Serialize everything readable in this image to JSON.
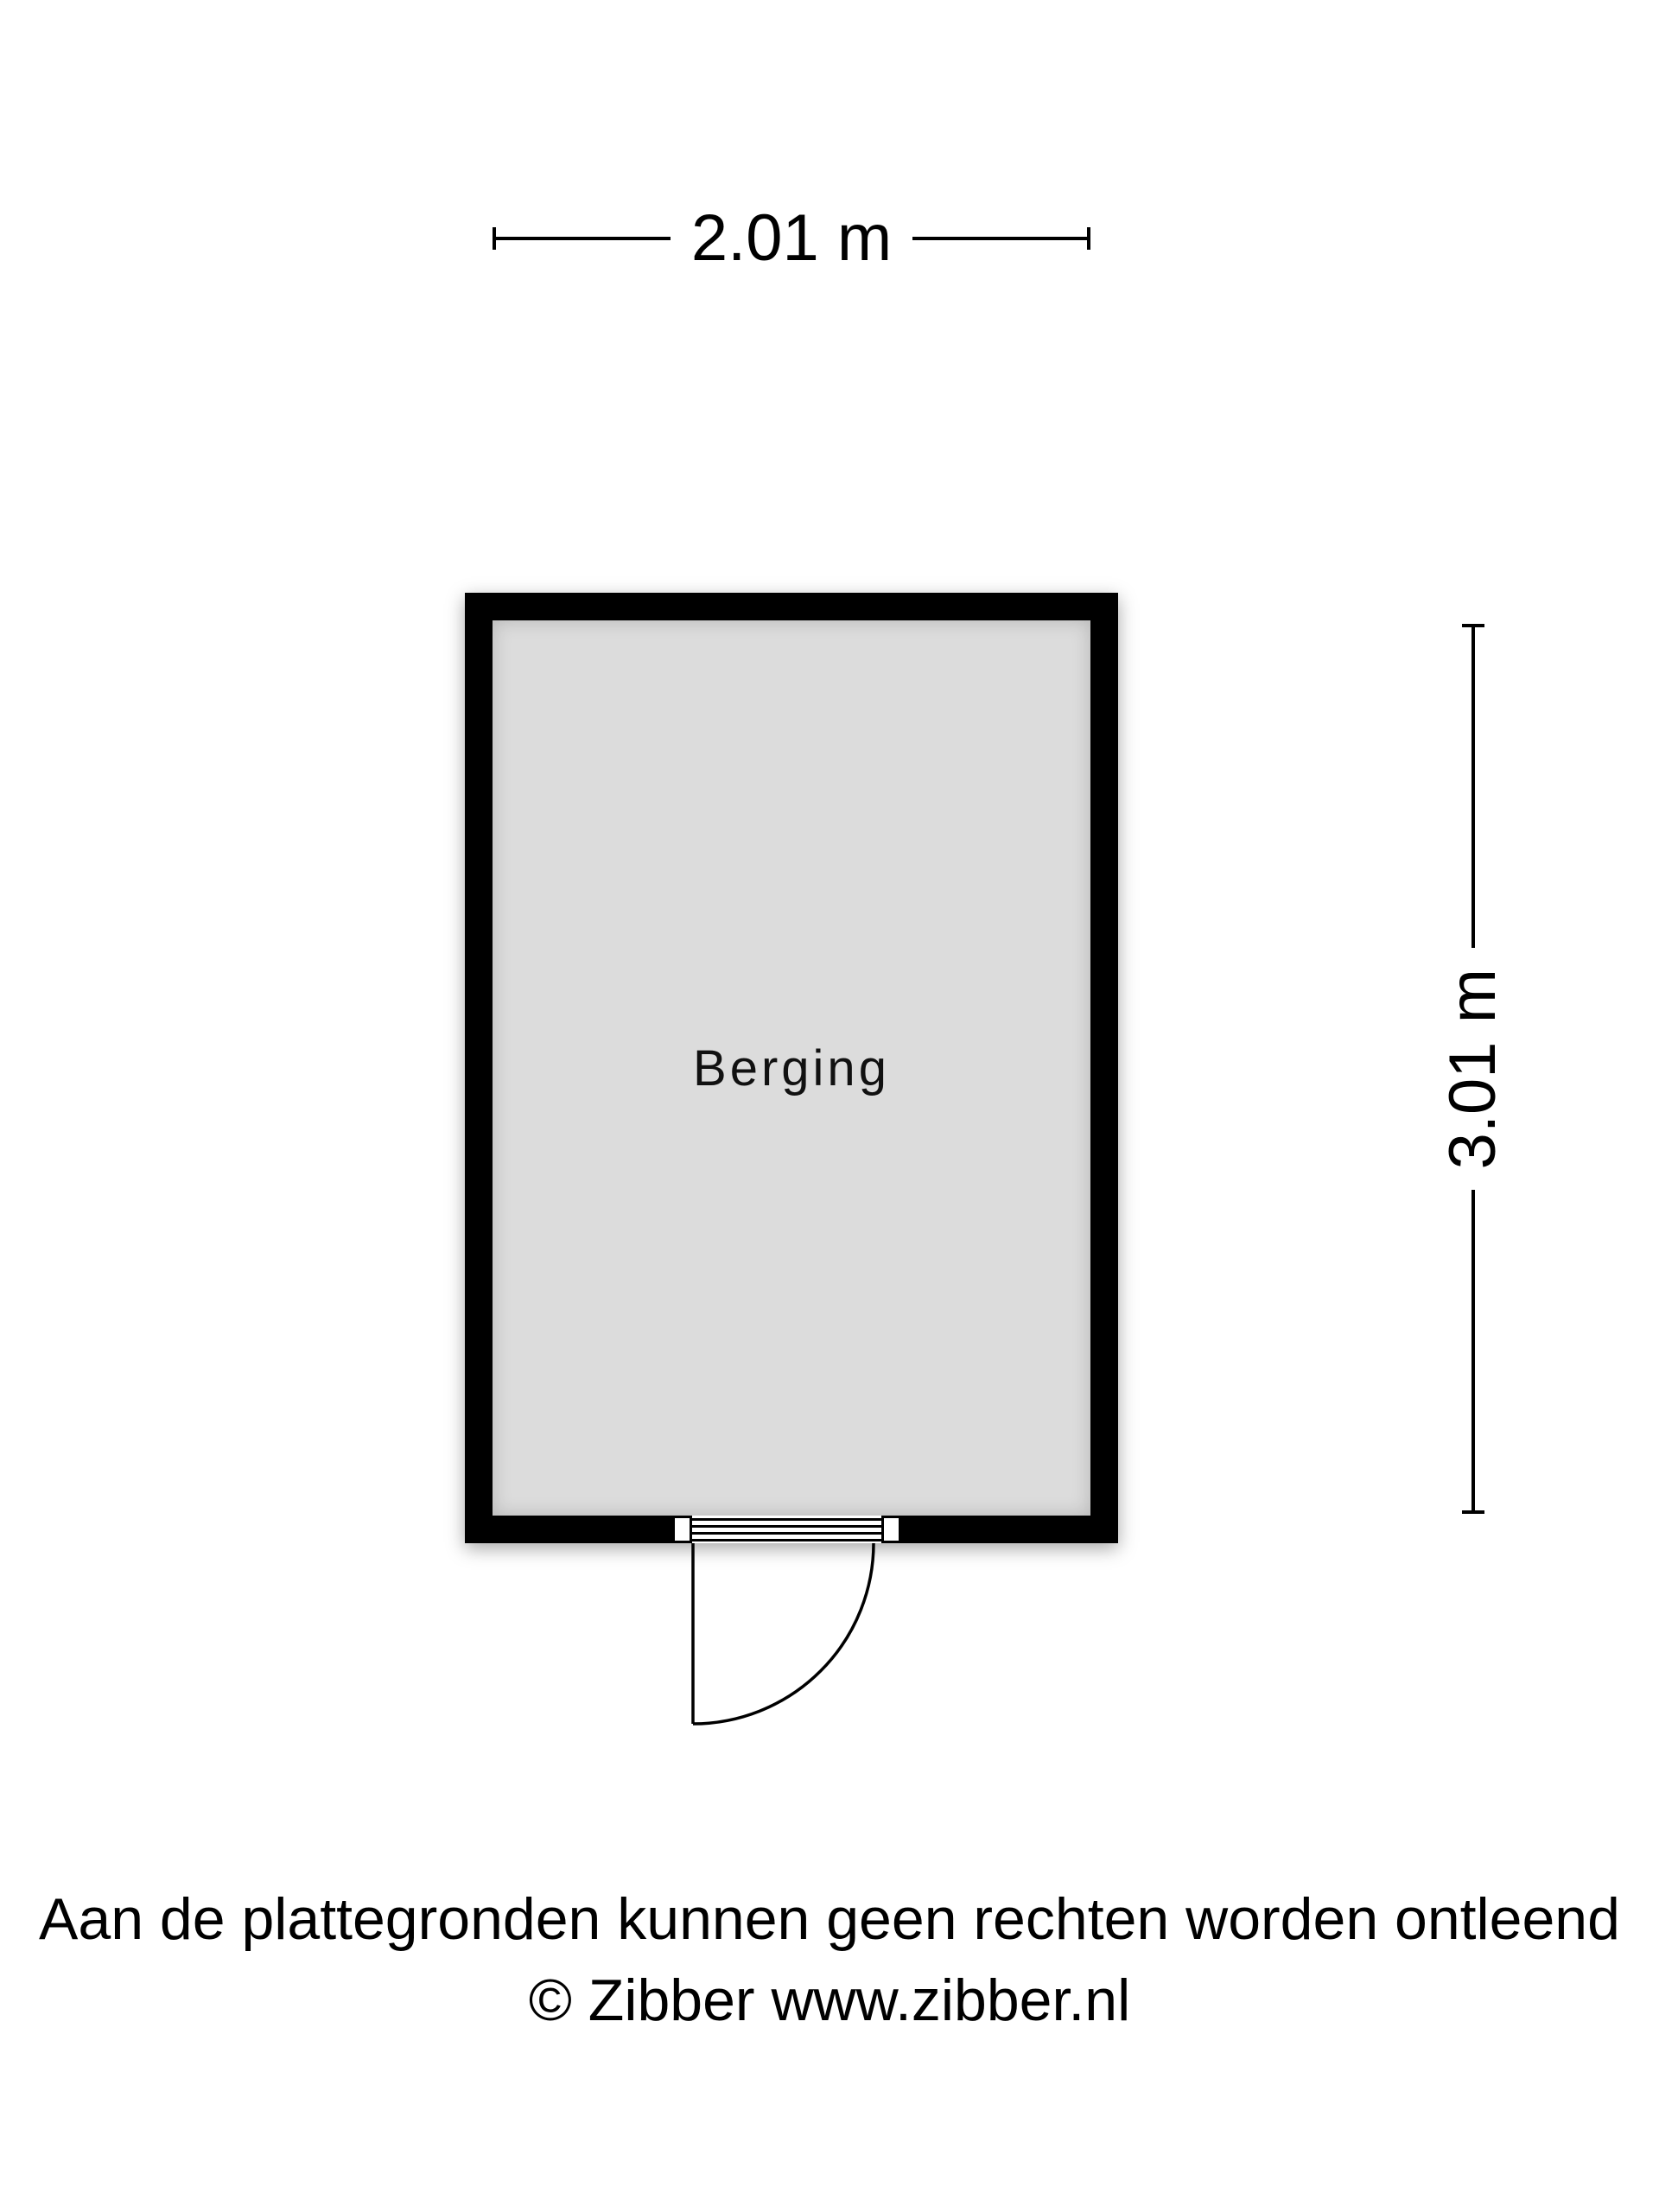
{
  "page": {
    "background": "#ffffff"
  },
  "floorplan": {
    "room": {
      "label": "Berging",
      "floor_color": "#dcdcdc",
      "wall_color": "#000000"
    },
    "dimensions": {
      "width_label": "2.01 m",
      "height_label": "3.01 m"
    },
    "door": {
      "type": "single-swing-door",
      "location": "bottom-wall-center"
    },
    "footer": {
      "disclaimer": "Aan de plattegronden kunnen geen rechten worden ontleend",
      "copyright": "© Zibber www.zibber.nl"
    }
  }
}
